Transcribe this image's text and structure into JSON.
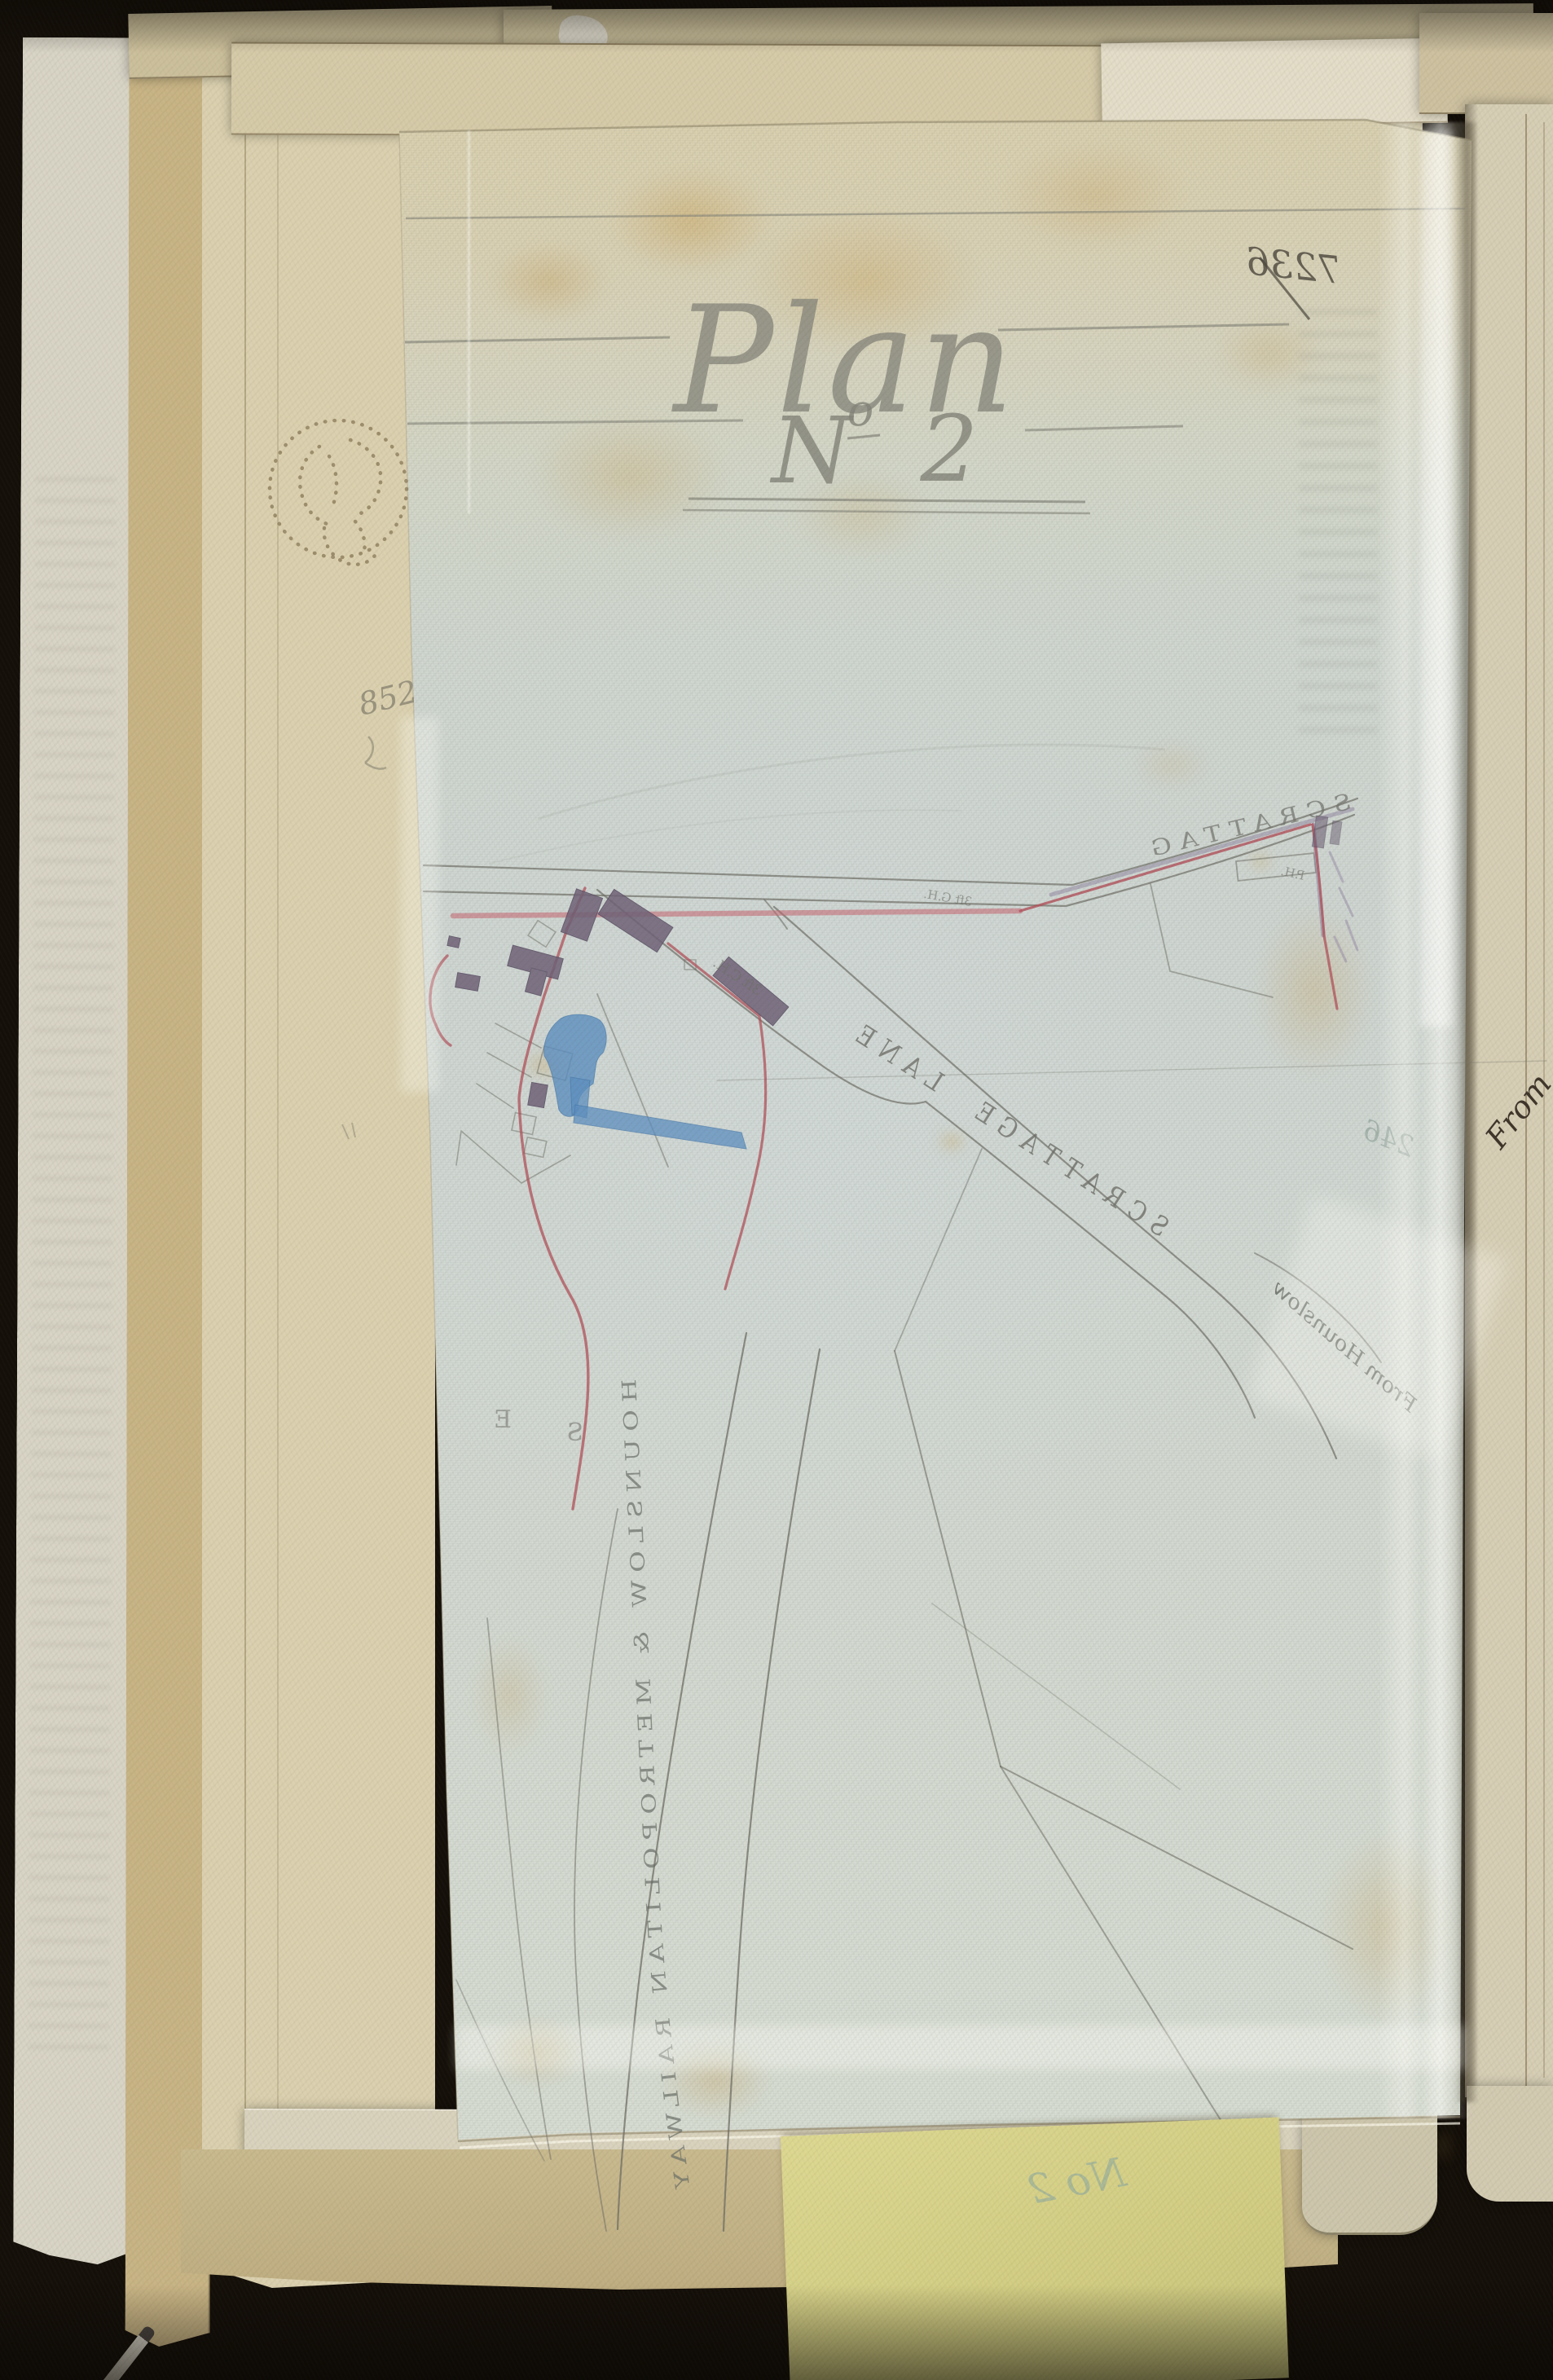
{
  "plan_sheet": {
    "title": "Plan",
    "number": {
      "n": "N",
      "sup": "o",
      "digit": "2"
    },
    "page_number_mirrored": "7236"
  },
  "map": {
    "labels": {
      "lane": "SCRATTAGE LANE",
      "road_top": "SCRATTAG",
      "from_hounslow": "From Hounslow",
      "railway": "HOUNSLOW & METROPOLITAN RAILWAY",
      "ch_note": "3ft C.H.",
      "gh_note": "3ft G.H.",
      "ph_note": "P.H.",
      "letter_e": "E",
      "letter_s": "S",
      "pencil_246": "246"
    },
    "colors": {
      "boundary_red": "#b0505a",
      "water_blue": "#5d8fc0",
      "building_purple": "#6e6176",
      "pencil_grey": "#6f6f66"
    }
  },
  "margin_notes": {
    "pencil_852": "852",
    "note_no2": "No 2",
    "adjacent_page_fragment": "From"
  }
}
